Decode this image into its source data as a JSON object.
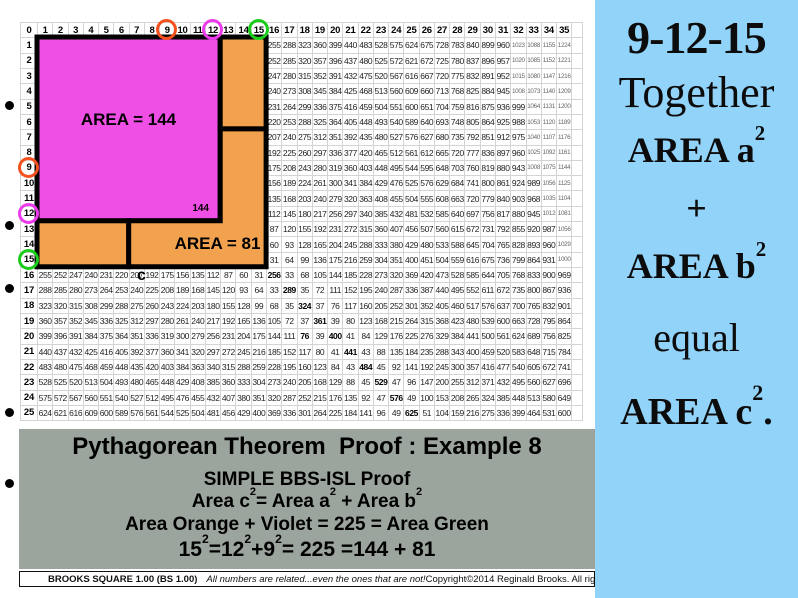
{
  "grid": {
    "corner": "0",
    "col_headers": [
      "1",
      "2",
      "3",
      "4",
      "5",
      "6",
      "7",
      "8",
      "9",
      "10",
      "11",
      "12",
      "13",
      "14",
      "15",
      "16",
      "17",
      "18",
      "19",
      "20",
      "21",
      "22",
      "23",
      "24",
      "25",
      "26",
      "27",
      "28",
      "29",
      "30",
      "31",
      "32",
      "33",
      "34",
      "35"
    ],
    "row_headers": [
      "1",
      "2",
      "3",
      "4",
      "5",
      "6",
      "7",
      "8",
      "9",
      "10",
      "11",
      "12",
      "13",
      "14",
      "15",
      "16",
      "17",
      "18",
      "19",
      "20",
      "21",
      "22",
      "23",
      "24",
      "25"
    ],
    "cells": [
      [
        "",
        "",
        "",
        "",
        "",
        "",
        "",
        "",
        "",
        "",
        "",
        "",
        "",
        "",
        "",
        "255",
        "288",
        "323",
        "360",
        "399",
        "440",
        "483",
        "528",
        "575",
        "624",
        "675",
        "728",
        "783",
        "840",
        "899",
        "960",
        "1023",
        "1088",
        "1155",
        "1224"
      ],
      [
        "",
        "",
        "",
        "",
        "",
        "",
        "",
        "",
        "",
        "",
        "",
        "",
        "",
        "",
        "",
        "252",
        "285",
        "320",
        "357",
        "396",
        "437",
        "480",
        "525",
        "572",
        "621",
        "672",
        "725",
        "780",
        "837",
        "896",
        "957",
        "1020",
        "1085",
        "1152",
        "1221"
      ],
      [
        "",
        "",
        "",
        "",
        "",
        "",
        "",
        "",
        "",
        "",
        "",
        "",
        "",
        "",
        "",
        "247",
        "280",
        "315",
        "352",
        "391",
        "432",
        "475",
        "520",
        "567",
        "616",
        "667",
        "720",
        "775",
        "832",
        "891",
        "952",
        "1015",
        "1080",
        "1147",
        "1216"
      ],
      [
        "",
        "",
        "",
        "",
        "",
        "",
        "",
        "",
        "",
        "",
        "",
        "",
        "",
        "",
        "",
        "240",
        "273",
        "308",
        "345",
        "384",
        "425",
        "468",
        "513",
        "560",
        "609",
        "660",
        "713",
        "768",
        "825",
        "884",
        "945",
        "1008",
        "1073",
        "1140",
        "1209"
      ],
      [
        "",
        "",
        "",
        "",
        "",
        "",
        "",
        "",
        "",
        "",
        "",
        "",
        "",
        "",
        "",
        "231",
        "264",
        "299",
        "336",
        "375",
        "416",
        "459",
        "504",
        "551",
        "600",
        "651",
        "704",
        "759",
        "816",
        "875",
        "936",
        "999",
        "1064",
        "1131",
        "1200"
      ],
      [
        "",
        "",
        "",
        "",
        "",
        "",
        "",
        "",
        "",
        "",
        "",
        "",
        "",
        "",
        "",
        "220",
        "253",
        "288",
        "325",
        "364",
        "405",
        "448",
        "493",
        "540",
        "589",
        "640",
        "693",
        "748",
        "805",
        "864",
        "925",
        "988",
        "1053",
        "1120",
        "1189"
      ],
      [
        "",
        "",
        "",
        "",
        "",
        "",
        "",
        "",
        "",
        "",
        "",
        "",
        "",
        "",
        "",
        "207",
        "240",
        "275",
        "312",
        "351",
        "392",
        "435",
        "480",
        "527",
        "576",
        "627",
        "680",
        "735",
        "792",
        "851",
        "912",
        "975",
        "1040",
        "1107",
        "1176"
      ],
      [
        "",
        "",
        "",
        "",
        "",
        "",
        "",
        "",
        "",
        "",
        "",
        "",
        "",
        "",
        "",
        "192",
        "225",
        "260",
        "297",
        "336",
        "377",
        "420",
        "465",
        "512",
        "561",
        "612",
        "665",
        "720",
        "777",
        "836",
        "897",
        "960",
        "1025",
        "1092",
        "1161"
      ],
      [
        "",
        "",
        "",
        "",
        "",
        "",
        "",
        "",
        "",
        "",
        "",
        "",
        "",
        "",
        "",
        "175",
        "208",
        "243",
        "280",
        "319",
        "360",
        "403",
        "448",
        "495",
        "544",
        "595",
        "648",
        "703",
        "760",
        "819",
        "880",
        "943",
        "1008",
        "1075",
        "1144"
      ],
      [
        "",
        "",
        "",
        "",
        "",
        "",
        "",
        "",
        "",
        "",
        "",
        "",
        "",
        "",
        "",
        "156",
        "189",
        "224",
        "261",
        "300",
        "341",
        "384",
        "429",
        "476",
        "525",
        "576",
        "629",
        "684",
        "741",
        "800",
        "861",
        "924",
        "989",
        "1056",
        "1125"
      ],
      [
        "",
        "",
        "",
        "",
        "",
        "",
        "",
        "",
        "",
        "",
        "",
        "",
        "",
        "",
        "",
        "135",
        "168",
        "203",
        "240",
        "279",
        "320",
        "363",
        "408",
        "455",
        "504",
        "555",
        "608",
        "663",
        "720",
        "779",
        "840",
        "903",
        "968",
        "1035",
        "1104"
      ],
      [
        "",
        "",
        "",
        "",
        "",
        "",
        "",
        "",
        "",
        "",
        "",
        "",
        "",
        "",
        "",
        "112",
        "145",
        "180",
        "217",
        "256",
        "297",
        "340",
        "385",
        "432",
        "481",
        "532",
        "585",
        "640",
        "697",
        "756",
        "817",
        "880",
        "945",
        "1012",
        "1081"
      ],
      [
        "",
        "",
        "",
        "",
        "",
        "",
        "",
        "",
        "",
        "",
        "",
        "",
        "",
        "",
        "",
        "87",
        "120",
        "155",
        "192",
        "231",
        "272",
        "315",
        "360",
        "407",
        "456",
        "507",
        "560",
        "615",
        "672",
        "731",
        "792",
        "855",
        "920",
        "987",
        "1056"
      ],
      [
        "",
        "",
        "",
        "",
        "",
        "",
        "",
        "",
        "",
        "",
        "",
        "",
        "",
        "",
        "",
        "60",
        "93",
        "128",
        "165",
        "204",
        "245",
        "288",
        "333",
        "380",
        "429",
        "480",
        "533",
        "588",
        "645",
        "704",
        "765",
        "828",
        "893",
        "960",
        "1029"
      ],
      [
        "",
        "",
        "",
        "",
        "",
        "",
        "",
        "",
        "",
        "",
        "",
        "",
        "",
        "",
        "",
        "31",
        "64",
        "99",
        "136",
        "175",
        "216",
        "259",
        "304",
        "351",
        "400",
        "451",
        "504",
        "559",
        "616",
        "675",
        "736",
        "799",
        "864",
        "931",
        "1000"
      ],
      [
        "255",
        "252",
        "247",
        "240",
        "231",
        "220",
        "207",
        "192",
        "175",
        "156",
        "135",
        "112",
        "87",
        "60",
        "31",
        "256",
        "33",
        "68",
        "105",
        "144",
        "185",
        "228",
        "273",
        "320",
        "369",
        "420",
        "473",
        "528",
        "585",
        "644",
        "705",
        "768",
        "833",
        "900",
        "969"
      ],
      [
        "288",
        "285",
        "280",
        "273",
        "264",
        "253",
        "240",
        "225",
        "208",
        "189",
        "168",
        "145",
        "120",
        "93",
        "64",
        "33",
        "289",
        "35",
        "72",
        "111",
        "152",
        "195",
        "240",
        "287",
        "336",
        "387",
        "440",
        "495",
        "552",
        "611",
        "672",
        "735",
        "800",
        "867",
        "936"
      ],
      [
        "323",
        "320",
        "315",
        "308",
        "299",
        "288",
        "275",
        "260",
        "243",
        "224",
        "203",
        "180",
        "155",
        "128",
        "99",
        "68",
        "35",
        "324",
        "37",
        "76",
        "117",
        "160",
        "205",
        "252",
        "301",
        "352",
        "405",
        "460",
        "517",
        "576",
        "637",
        "700",
        "765",
        "832",
        "901"
      ],
      [
        "360",
        "357",
        "352",
        "345",
        "336",
        "325",
        "312",
        "297",
        "280",
        "261",
        "240",
        "217",
        "192",
        "165",
        "136",
        "105",
        "72",
        "37",
        "361",
        "39",
        "80",
        "123",
        "168",
        "215",
        "264",
        "315",
        "368",
        "423",
        "480",
        "539",
        "600",
        "663",
        "728",
        "795",
        "864"
      ],
      [
        "399",
        "396",
        "391",
        "384",
        "375",
        "364",
        "351",
        "336",
        "319",
        "300",
        "279",
        "256",
        "231",
        "204",
        "175",
        "144",
        "111",
        "76",
        "39",
        "400",
        "41",
        "84",
        "129",
        "176",
        "225",
        "276",
        "329",
        "384",
        "441",
        "500",
        "561",
        "624",
        "689",
        "756",
        "825"
      ],
      [
        "440",
        "437",
        "432",
        "425",
        "416",
        "405",
        "392",
        "377",
        "360",
        "341",
        "320",
        "297",
        "272",
        "245",
        "216",
        "185",
        "152",
        "117",
        "80",
        "41",
        "441",
        "43",
        "88",
        "135",
        "184",
        "235",
        "288",
        "343",
        "400",
        "459",
        "520",
        "583",
        "648",
        "715",
        "784"
      ],
      [
        "483",
        "480",
        "475",
        "468",
        "459",
        "448",
        "435",
        "420",
        "403",
        "384",
        "363",
        "340",
        "315",
        "288",
        "259",
        "228",
        "195",
        "160",
        "123",
        "84",
        "43",
        "484",
        "45",
        "92",
        "141",
        "192",
        "245",
        "300",
        "357",
        "416",
        "477",
        "540",
        "605",
        "672",
        "741"
      ],
      [
        "528",
        "525",
        "520",
        "513",
        "504",
        "493",
        "480",
        "465",
        "448",
        "429",
        "408",
        "385",
        "360",
        "333",
        "304",
        "273",
        "240",
        "205",
        "168",
        "129",
        "88",
        "45",
        "529",
        "47",
        "96",
        "147",
        "200",
        "255",
        "312",
        "371",
        "432",
        "495",
        "560",
        "627",
        "696"
      ],
      [
        "575",
        "572",
        "567",
        "560",
        "551",
        "540",
        "527",
        "512",
        "495",
        "476",
        "455",
        "432",
        "407",
        "380",
        "351",
        "320",
        "287",
        "252",
        "215",
        "176",
        "135",
        "92",
        "47",
        "576",
        "49",
        "100",
        "153",
        "208",
        "265",
        "324",
        "385",
        "448",
        "513",
        "580",
        "649"
      ],
      [
        "624",
        "621",
        "616",
        "609",
        "600",
        "589",
        "576",
        "561",
        "544",
        "525",
        "504",
        "481",
        "456",
        "429",
        "400",
        "369",
        "336",
        "301",
        "264",
        "225",
        "184",
        "141",
        "96",
        "49",
        "625",
        "51",
        "104",
        "159",
        "216",
        "275",
        "336",
        "399",
        "464",
        "531",
        "600"
      ]
    ],
    "bold_cells": [
      [
        16,
        16
      ],
      [
        17,
        17
      ],
      [
        18,
        18
      ],
      [
        19,
        19
      ],
      [
        20,
        18
      ],
      [
        20,
        20
      ],
      [
        21,
        21
      ],
      [
        22,
        22
      ],
      [
        23,
        23
      ],
      [
        24,
        24
      ],
      [
        25,
        25
      ]
    ],
    "circles": [
      {
        "axis": "col",
        "n": 9,
        "color": "#f4511e"
      },
      {
        "axis": "col",
        "n": 12,
        "color": "#ec3bec"
      },
      {
        "axis": "col",
        "n": 15,
        "color": "#1bcd1b"
      },
      {
        "axis": "row",
        "n": 9,
        "color": "#f4511e"
      },
      {
        "axis": "row",
        "n": 12,
        "color": "#ec3bec"
      },
      {
        "axis": "row",
        "n": 15,
        "color": "#1bcd1b"
      }
    ],
    "margin_dots_y": [
      105,
      225,
      288,
      412,
      483
    ]
  },
  "shapes": {
    "violet_fill": "#f04fe6",
    "orange_fill": "#f2a24e",
    "border": "#000000",
    "area_violet_label": "AREA = 144",
    "corner_label": "144",
    "area_orange_label": "AREA = 81",
    "side_label": "c"
  },
  "proof_panel": {
    "bg": "#9ca49e",
    "title": "Pythagorean Theorem  Proof : Example 8",
    "lines": [
      {
        "cls": "p-sub",
        "segs": [
          [
            "SIMPLE BBS-ISL Proof",
            0
          ]
        ]
      },
      {
        "cls": "p-eq",
        "segs": [
          [
            "Area c",
            0
          ],
          [
            "2",
            1
          ],
          [
            "= Area a",
            0
          ],
          [
            "2",
            1
          ],
          [
            " + Area b",
            0
          ],
          [
            "2",
            1
          ]
        ]
      },
      {
        "cls": "p-colors",
        "segs": [
          [
            "Area Orange + Violet = 225 = Area Green",
            0
          ]
        ]
      },
      {
        "cls": "p-nums",
        "segs": [
          [
            "15",
            0
          ],
          [
            "2",
            1
          ],
          [
            "=12",
            0
          ],
          [
            "2",
            1
          ],
          [
            "+9",
            0
          ],
          [
            "2",
            1
          ],
          [
            "= 225 =144 + 81",
            0
          ]
        ]
      }
    ]
  },
  "footer": {
    "brand": "BROOKS SQUARE 1.00 (BS 1.00)",
    "tagline": "All numbers are related...even the ones that are not!",
    "copyright": "Copyright©2014 Reginald Brooks. All rights reserved."
  },
  "side_panel": {
    "bg": "#92d3fa",
    "lines": [
      {
        "cls": "s-triple",
        "text": "9-12-15",
        "sup": "",
        "tail": ""
      },
      {
        "cls": "s-word",
        "text": "Together",
        "sup": "",
        "tail": ""
      },
      {
        "cls": "s-area",
        "text": "AREA a",
        "sup": "2",
        "tail": ""
      },
      {
        "cls": "s-plus",
        "text": "+",
        "sup": "",
        "tail": ""
      },
      {
        "cls": "s-area",
        "text": "AREA b",
        "sup": "2",
        "tail": ""
      },
      {
        "cls": "s-word s-equal",
        "text": "equal",
        "sup": "",
        "tail": ""
      },
      {
        "cls": "s-area s-area-c",
        "text": "AREA c",
        "sup": "2",
        "tail": "."
      }
    ]
  }
}
